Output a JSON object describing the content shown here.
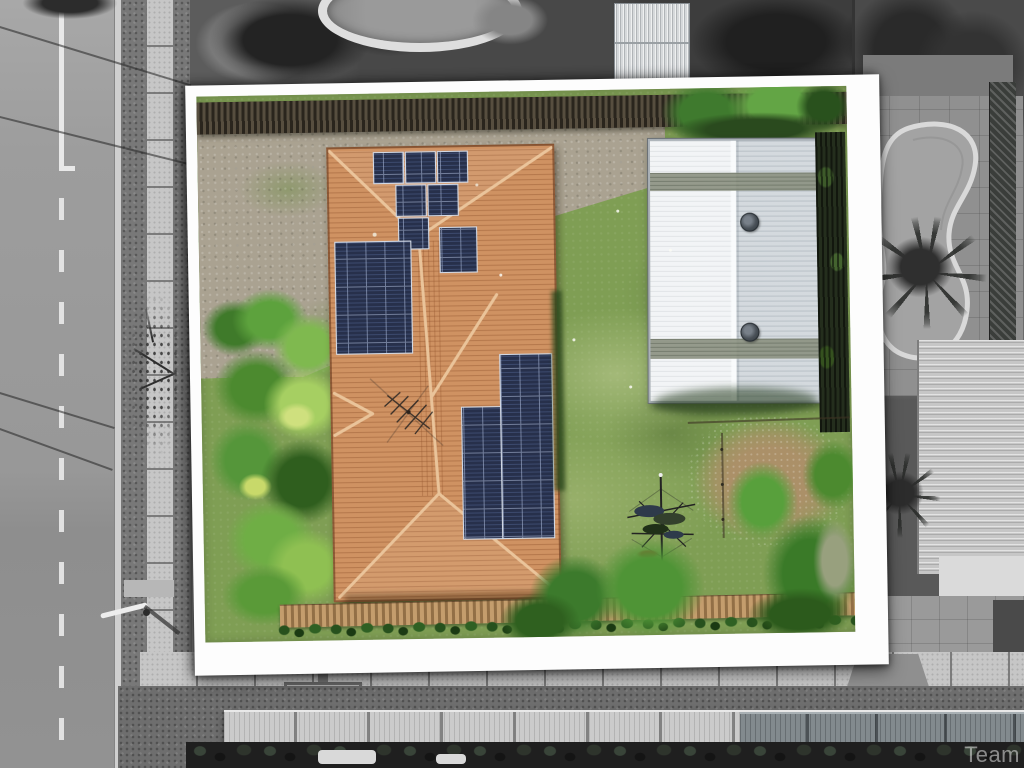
{
  "meta": {
    "description": "Aerial drone photograph of a residential property; the listed block is shown in full colour inside a white tilted frame while all surroundings are greyscale",
    "width_px": 1024,
    "height_px": 768
  },
  "watermark": {
    "text": "Team"
  },
  "palette": {
    "frame": "#fdfdfd",
    "roof": "#cf9262",
    "roof_ridge": "#ecc79e",
    "panel": "#27304b",
    "lawn": "#7f9e54",
    "gravel": "#aaa291",
    "dirt": "#ab9068",
    "palm": "#4c8a2f",
    "fence_dark": "#332c23",
    "fence_tan": "#b08d5f",
    "shed": "#e3e7ea",
    "shed_band": "#8e9484",
    "road": "#9c9c9c",
    "road_line": "#e8e8e8",
    "verge": "#787878",
    "path": "#c6c6c6",
    "concrete": "#b7b7b7",
    "awning": "#cbcbcb",
    "pool_deck": "#909090",
    "pool_water": "#a3a3a3",
    "pool_coping": "#d9d9d9",
    "gray_roof": "#c6c6c6",
    "dark_foliage": "#1f1f1f"
  },
  "property": {
    "features": [
      "terracotta tiled hip roof",
      "rooftop solar arrays",
      "white metal shed with two roof vents",
      "rotary clothesline",
      "palm garden",
      "lawn",
      "timber fences"
    ],
    "solar_arrays": [
      {
        "location": "front hip",
        "panels": 6
      },
      {
        "location": "left slope",
        "panels": 16
      },
      {
        "location": "centre slope",
        "panels": 6
      },
      {
        "location": "rear slope",
        "panels": 26
      }
    ]
  },
  "surroundings": {
    "left": "street with centre line, kerb, grass verge and footpath",
    "top": "rear neighbour backyard with round pool and small shed",
    "right": "neighbouring property with freeform swimming pool and palms",
    "bottom": "footpath, driveway pad and patio awnings with plants"
  }
}
